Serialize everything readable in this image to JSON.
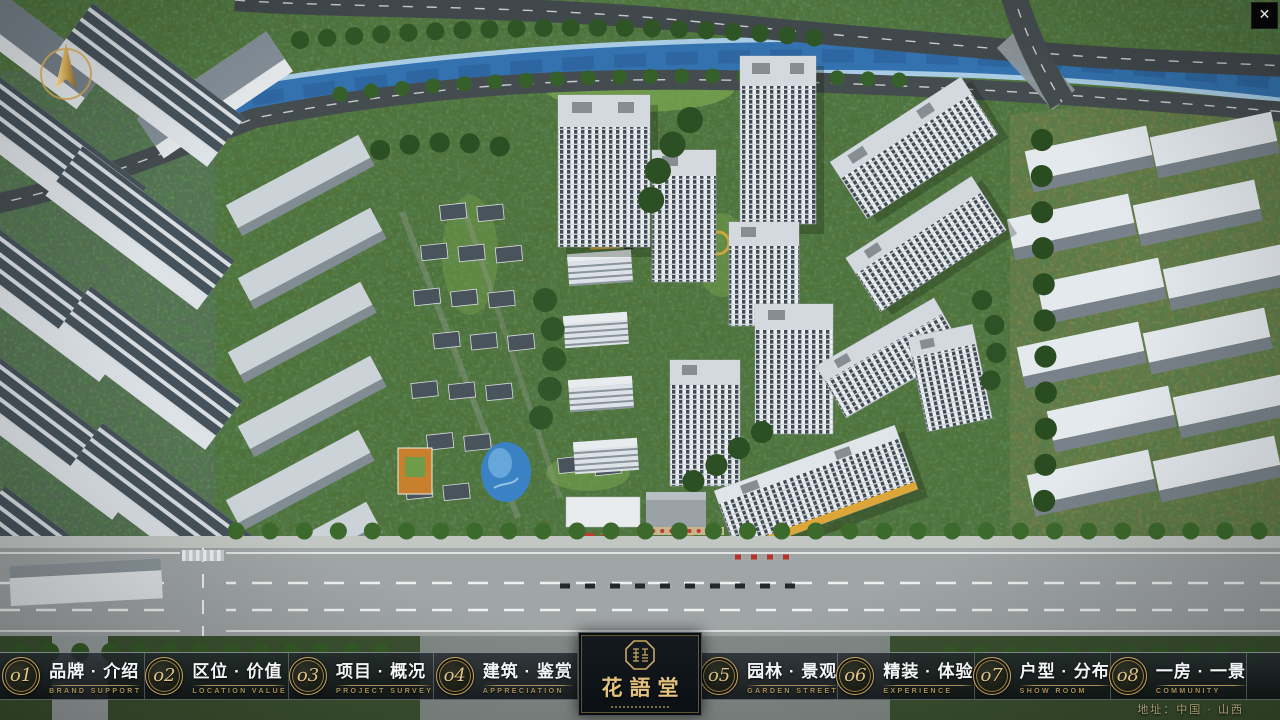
{
  "app": {
    "close_icon": "✕"
  },
  "logo": {
    "title": "花語堂"
  },
  "footer": {
    "address": "地址：中国 · 山西"
  },
  "nav": {
    "items": [
      {
        "num": "o1",
        "zh": "品牌 · 介绍",
        "en": "BRAND SUPPORT"
      },
      {
        "num": "o2",
        "zh": "区位 · 价值",
        "en": "LOCATION VALUE"
      },
      {
        "num": "o3",
        "zh": "项目 · 概况",
        "en": "PROJECT SURVEY"
      },
      {
        "num": "o4",
        "zh": "建筑 · 鉴赏",
        "en": "APPRECIATION"
      },
      {
        "num": "o5",
        "zh": "园林 · 景观",
        "en": "GARDEN STREET"
      },
      {
        "num": "o6",
        "zh": "精装 · 体验",
        "en": "EXPERIENCE"
      },
      {
        "num": "o7",
        "zh": "户型 · 分布",
        "en": "SHOW ROOM"
      },
      {
        "num": "o8",
        "zh": "一房 · 一景",
        "en": "COMMUNITY"
      }
    ]
  }
}
